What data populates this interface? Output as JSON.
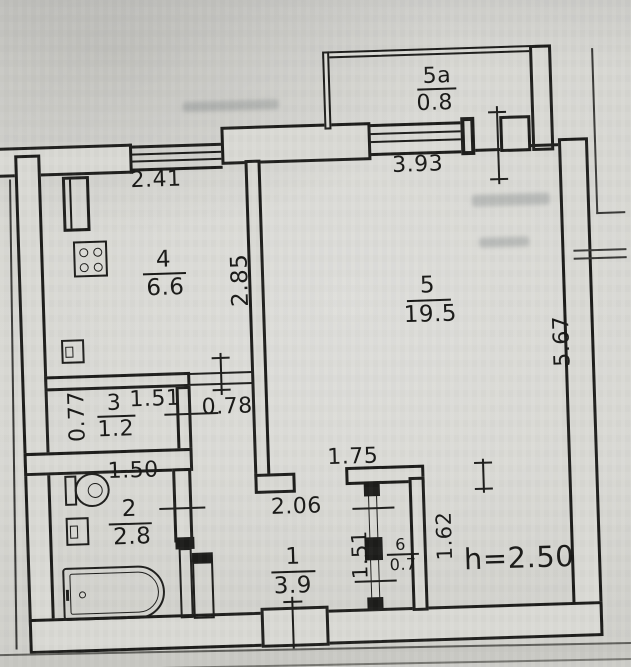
{
  "plan_type": "apartment-floor-plan",
  "height_note": "h=2.50",
  "rooms": {
    "r5a": {
      "number": "5a",
      "area": "0.8"
    },
    "r4": {
      "number": "4",
      "area": "6.6"
    },
    "r5": {
      "number": "5",
      "area": "19.5"
    },
    "r3": {
      "number": "3",
      "area": "1.2"
    },
    "r2": {
      "number": "2",
      "area": "2.8"
    },
    "r1": {
      "number": "1",
      "area": "3.9"
    },
    "r6": {
      "number": "6",
      "area": "0.7"
    }
  },
  "dims": {
    "kitchen_window": "2.41",
    "living_window": "3.93",
    "kitchen_depth": "2.85",
    "right_wall": "5.67",
    "room3_height": "0.77",
    "room3_width": "1.51",
    "kitchen_door": "0.78",
    "bath_width": "1.50",
    "hall_width": "2.06",
    "hall_top_wall": "1.75",
    "closet_left": "1.51",
    "closet_right": "1.62"
  },
  "fixtures": {
    "kitchen": [
      "vent-duct",
      "stove",
      "sink"
    ],
    "bathroom": [
      "toilet",
      "sink",
      "bathtub"
    ]
  },
  "colors": {
    "ink": "#1d1d1b",
    "paper": "#d6d6d1"
  }
}
